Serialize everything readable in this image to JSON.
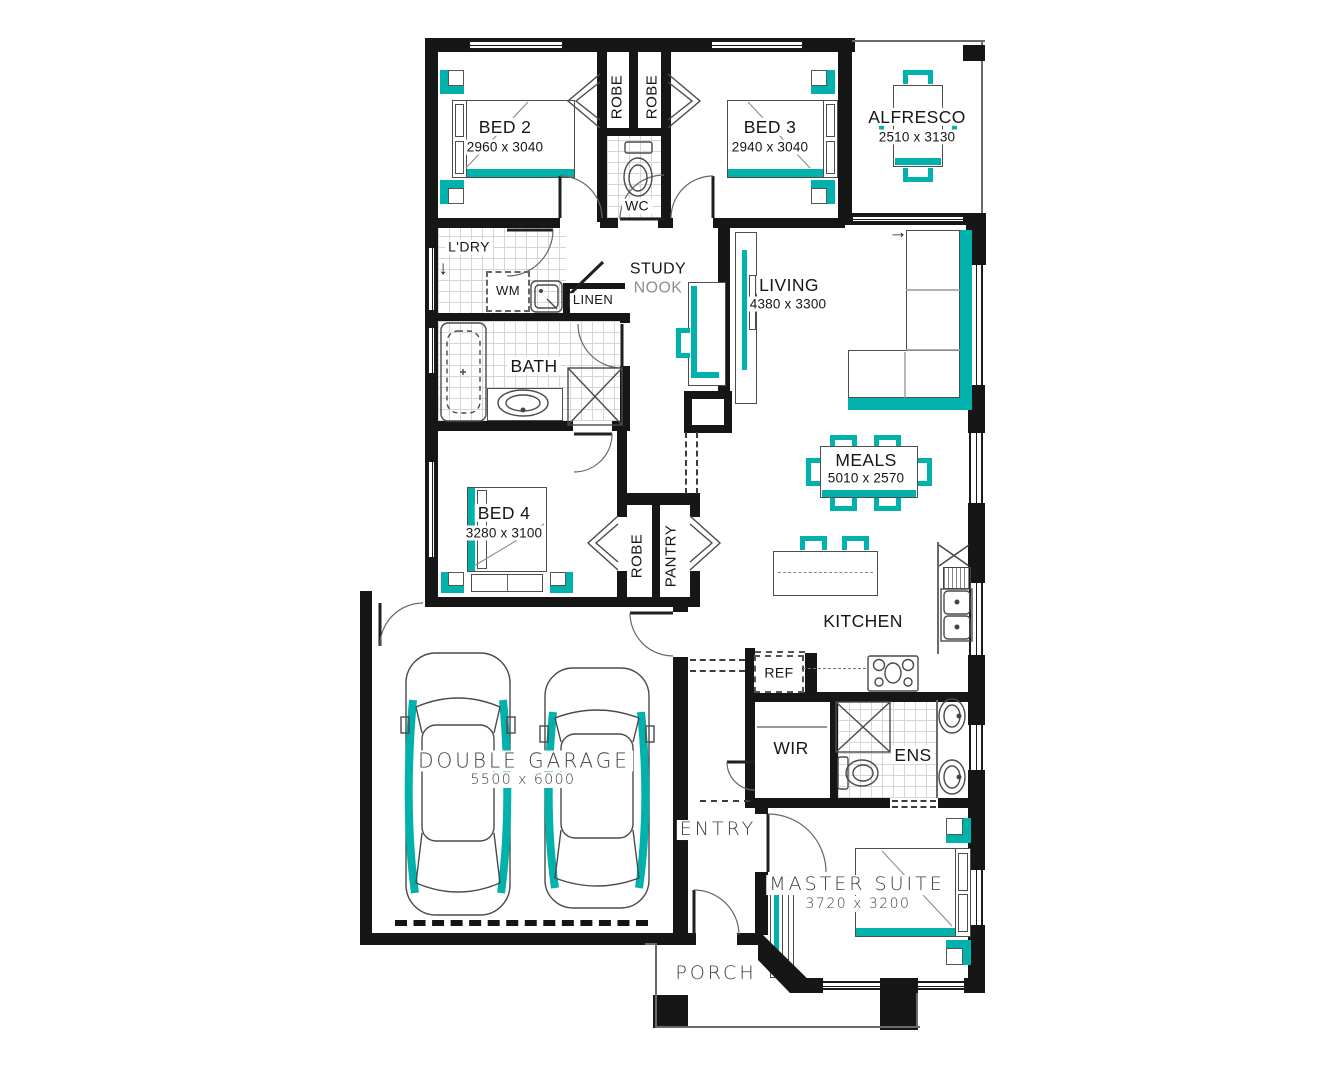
{
  "palette": {
    "accent_teal": "#00b2ab",
    "wall_black": "#161616",
    "tile_gray": "#d6d6d6"
  },
  "rooms": {
    "bed2": {
      "name": "BED 2",
      "dims": "2960 x 3040"
    },
    "bed3": {
      "name": "BED 3",
      "dims": "2940 x 3040"
    },
    "alfresco": {
      "name": "ALFRESCO",
      "dims": "2510 x 3130"
    },
    "wc": {
      "name": "WC"
    },
    "ldry": {
      "name": "L'DRY"
    },
    "wm": {
      "name": "WM"
    },
    "linen": {
      "name": "LINEN"
    },
    "study": {
      "line1": "STUDY",
      "line2": "NOOK"
    },
    "living": {
      "name": "LIVING",
      "dims": "4380 x 3300"
    },
    "bath": {
      "name": "BATH"
    },
    "meals": {
      "name": "MEALS",
      "dims": "5010 x 2570"
    },
    "bed4": {
      "name": "BED 4",
      "dims": "3280 x 3100"
    },
    "robe1": {
      "name": "ROBE"
    },
    "robe2": {
      "name": "ROBE"
    },
    "robe3": {
      "name": "ROBE"
    },
    "pantry": {
      "name": "PANTRY"
    },
    "kitchen": {
      "name": "KITCHEN"
    },
    "ref": {
      "name": "REF"
    },
    "garage": {
      "name": "DOUBLE GARAGE",
      "dims": "5500 x 6000"
    },
    "wir": {
      "name": "WIR"
    },
    "ens": {
      "name": "ENS"
    },
    "entry": {
      "name": "ENTRY"
    },
    "master": {
      "name": "MASTER SUITE",
      "dims": "3720 x 3200"
    },
    "porch": {
      "name": "PORCH"
    }
  },
  "symbols": {
    "ldry_door_arrow": "↓",
    "sliding_door_arrow": "→"
  }
}
